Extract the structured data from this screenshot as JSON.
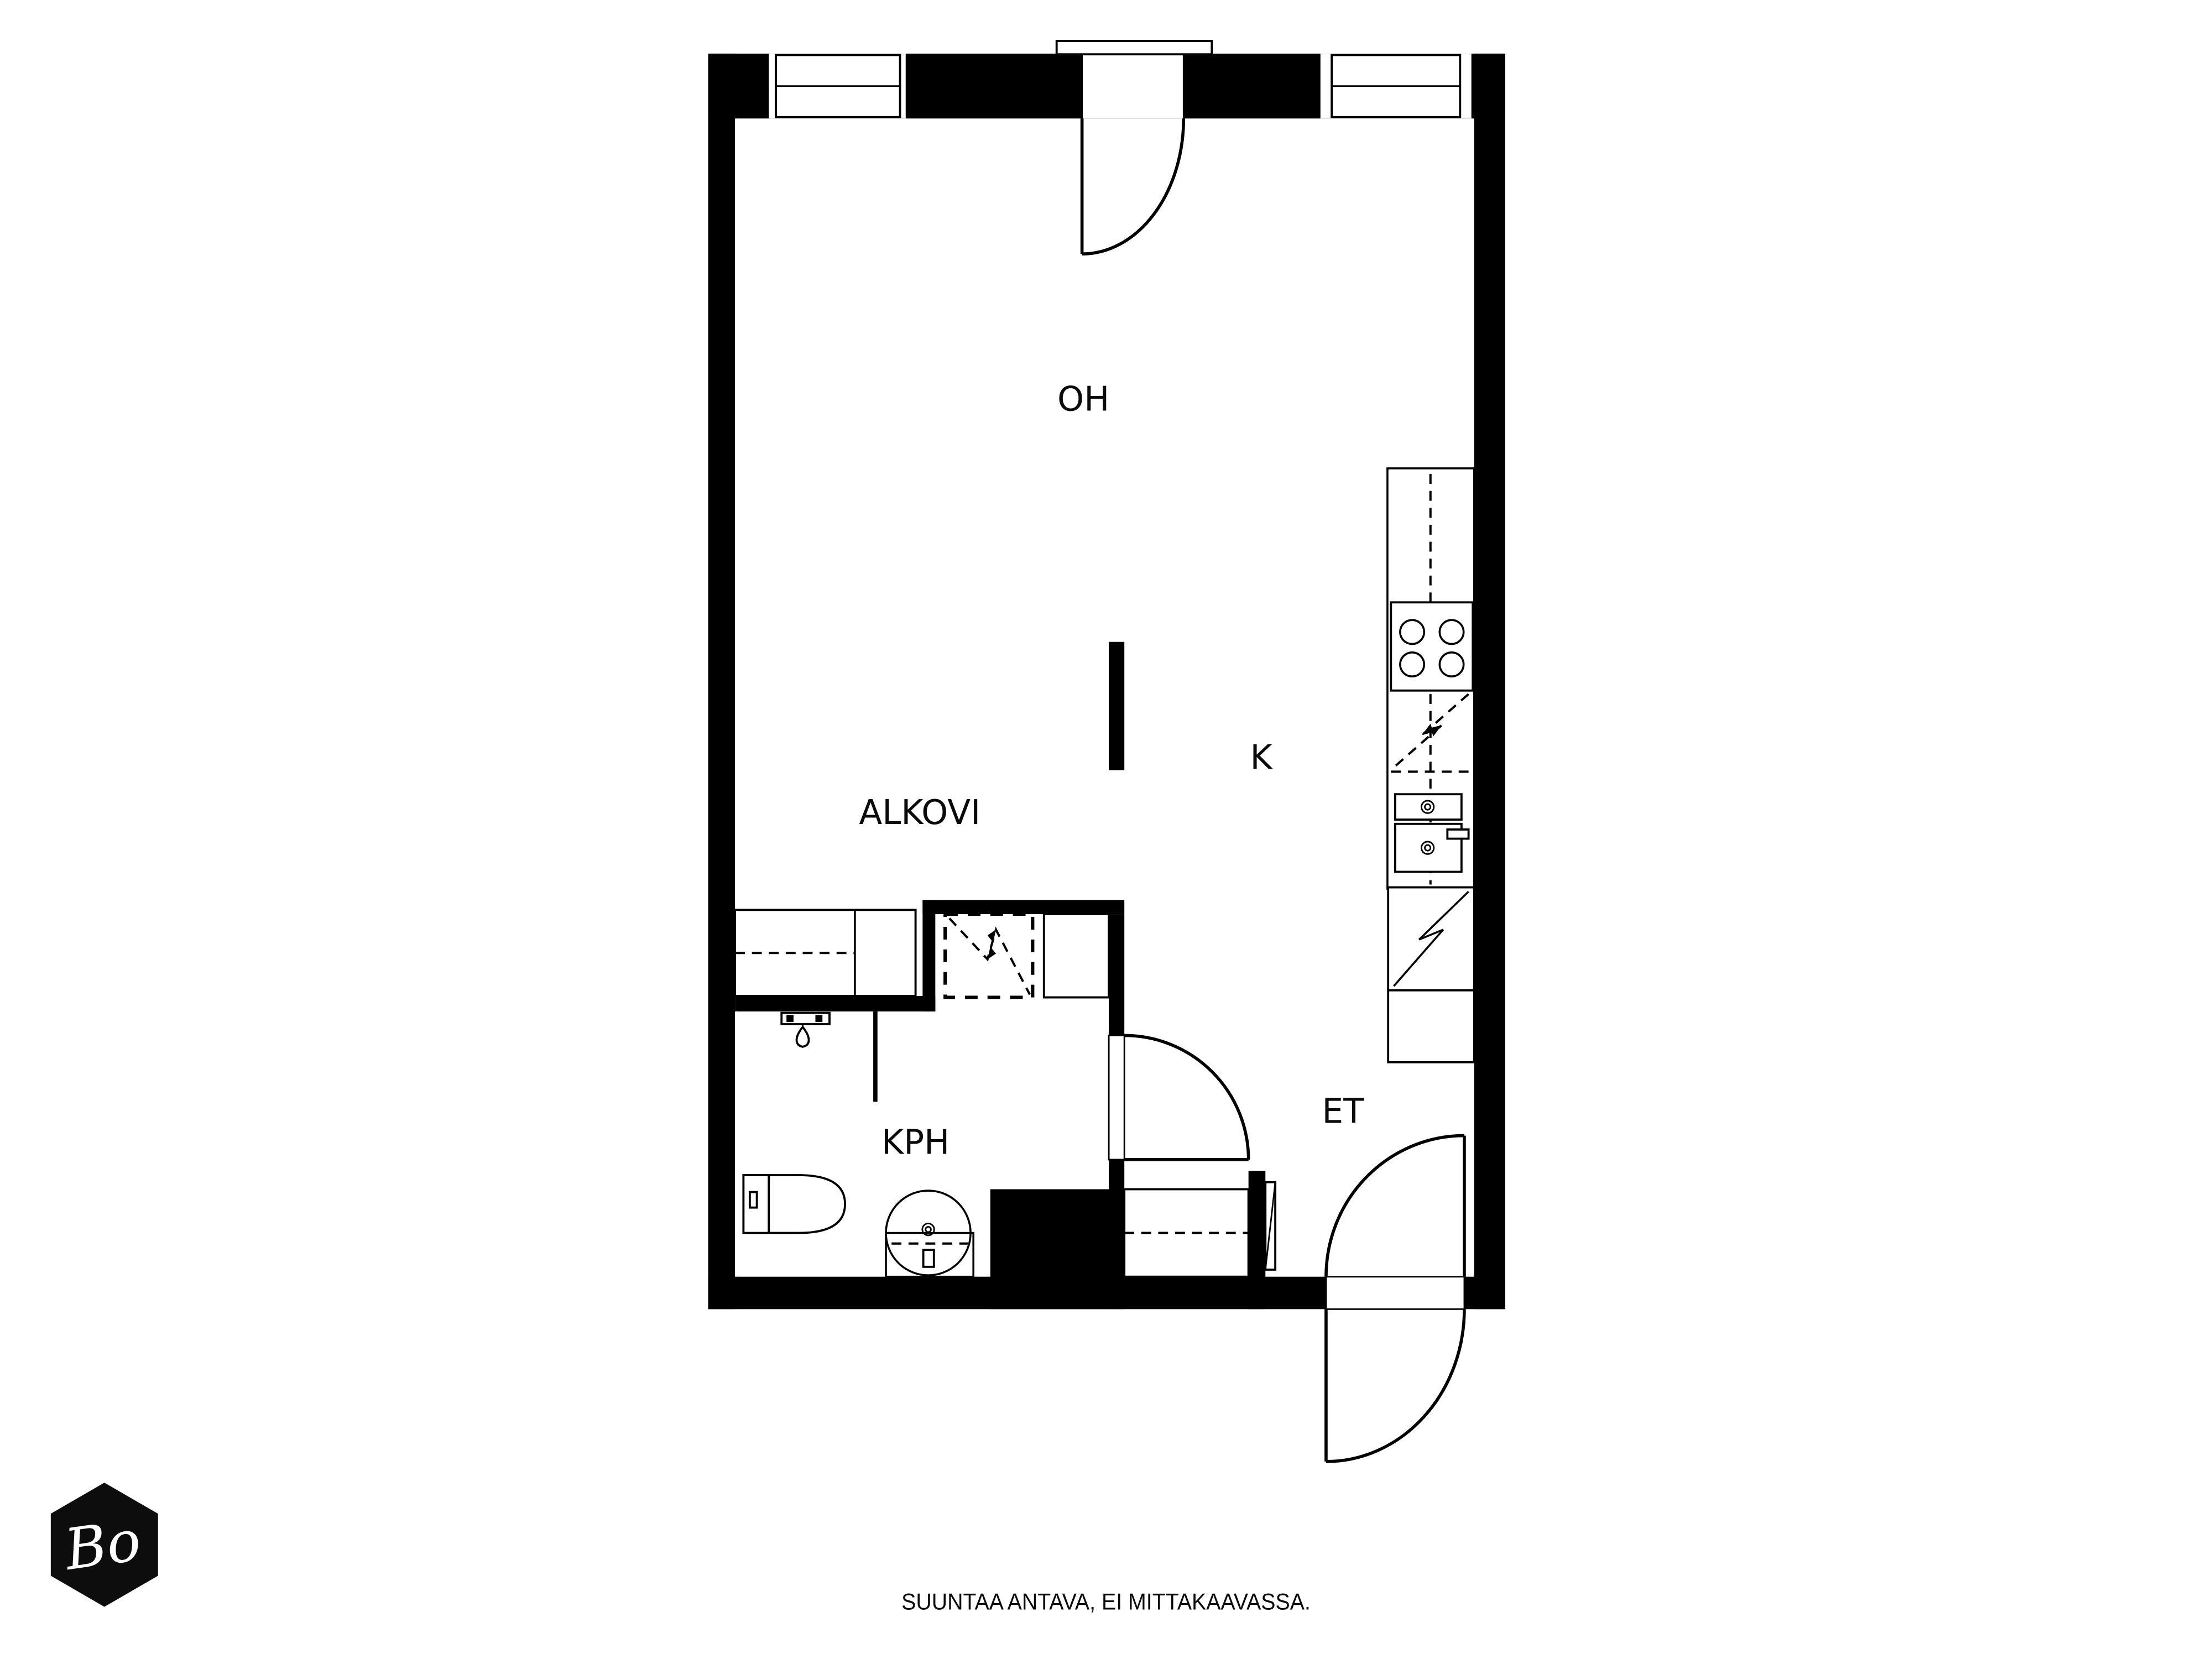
{
  "plan": {
    "background": "#ffffff",
    "wall_color": "#000000",
    "line_color": "#000000",
    "rooms": [
      {
        "id": "oh",
        "label": "OH"
      },
      {
        "id": "k",
        "label": "K"
      },
      {
        "id": "alkovi",
        "label": "ALKOVI"
      },
      {
        "id": "kph",
        "label": "KPH"
      },
      {
        "id": "et",
        "label": "ET"
      }
    ],
    "fixtures": [
      "window",
      "balcony-door",
      "entry-door",
      "bathroom-door",
      "kitchen-counter",
      "stove",
      "dishwasher-reservation",
      "sink",
      "fridge",
      "kitchen-cabinet",
      "washing-machine-reservation",
      "utility-cabinet",
      "wardrobe",
      "alcove-bed",
      "toilet",
      "washbasin",
      "shower-mixer",
      "shower-screen"
    ]
  },
  "footer": {
    "disclaimer": "SUUNTAA ANTAVA, EI MITTAKAAVASSA."
  },
  "logo": {
    "text": "Bo",
    "shape": "hexagon",
    "background": "#0d0d0d",
    "color": "#ffffff"
  }
}
